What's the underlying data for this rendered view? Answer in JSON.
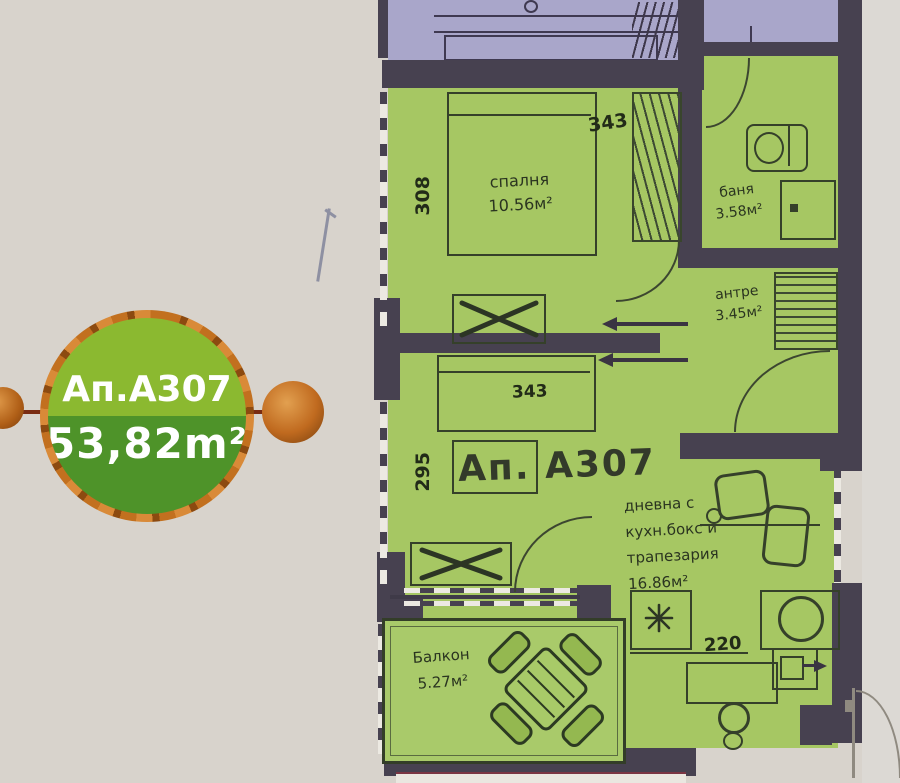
{
  "badge": {
    "unit": "Ап.А307",
    "area": "53,82m²"
  },
  "plan": {
    "unit_label": "Ап. А307",
    "bedroom": {
      "name": "спалня",
      "area": "10.56м²"
    },
    "bathroom": {
      "name": "баня",
      "area": "3.58м²"
    },
    "hall": {
      "name": "антре",
      "area": "3.45м²"
    },
    "living": {
      "line1": "дневна с",
      "line2": "кухн.бокс и",
      "line3": "трапезария",
      "area": "16.86м²"
    },
    "balcony": {
      "name": "Балкон",
      "area": "5.27м²"
    },
    "dims": {
      "bedroom_w": "343",
      "bedroom_h": "308",
      "living_h": "295",
      "sofa_w": "343",
      "kitchen_w": "220"
    }
  },
  "colors": {
    "badge_green_top": "#8bb930",
    "badge_green_bottom": "#4e9329",
    "badge_orange": "#c2701f",
    "badge_line": "#7a2c12",
    "plan_green": "#a6c763",
    "balcony_green": "#a9ca6a",
    "neighbor_purple": "#a9a6ca",
    "wall_dark": "#474150",
    "background_beige": "#d8d3cc"
  }
}
